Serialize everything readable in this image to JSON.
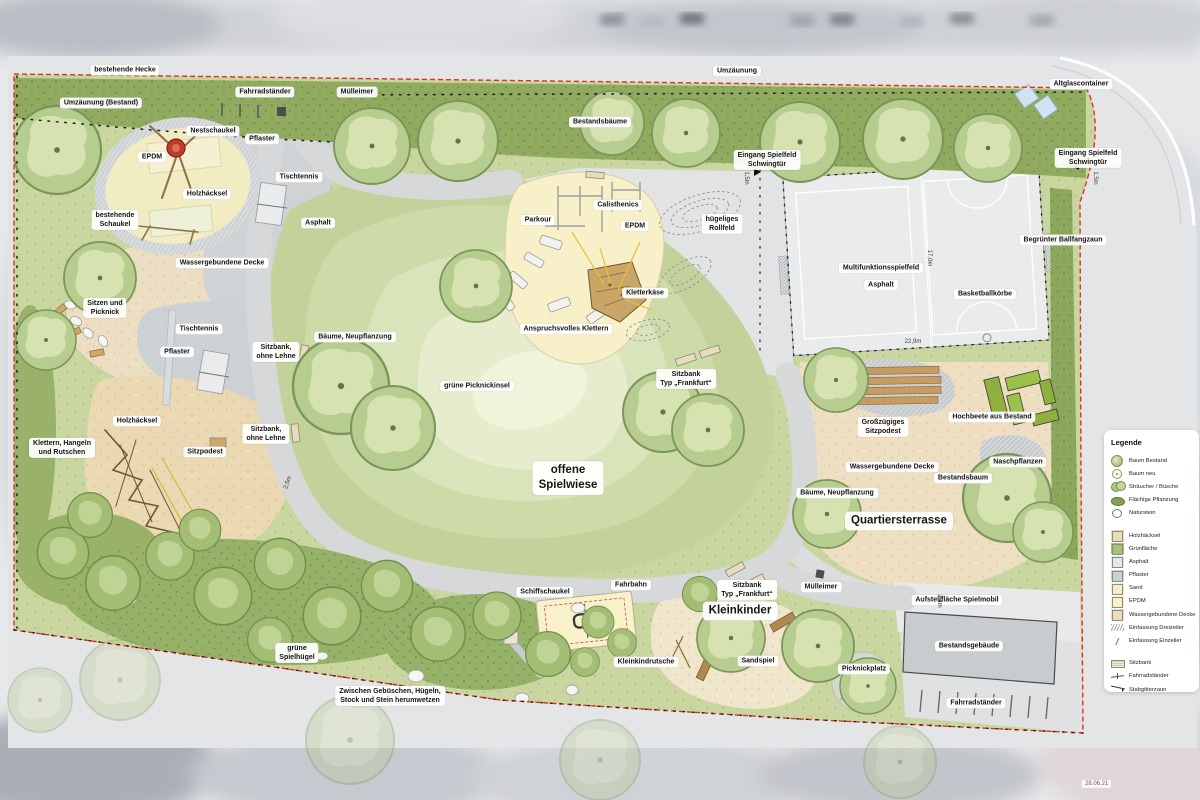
{
  "meta": {
    "date_stamp": "28.06.21"
  },
  "palette": {
    "boundary_red": "#e03024",
    "hedge_green": "#90aa60",
    "lawn_green": "#c9d6a0",
    "meadow_light": "#e7edcc",
    "path_gray": "#d7d8d9",
    "pflaster_gray": "#cfd3d6",
    "asphalt_gray": "#e6e7e9",
    "epdm_yellow": "#f7f0c8",
    "sand_beige": "#f0e6cb",
    "wgd_beige": "#ecdec2",
    "holzhaecksel_tan": "#ead9b2",
    "wood_brown": "#c79c63",
    "bed_green": "#9cc14a",
    "glass_blue": "#cfe3f0"
  },
  "plan_labels": [
    {
      "text": "bestehende Hecke",
      "x": 125,
      "y": 70
    },
    {
      "text": "Umzäunung (Bestand)",
      "x": 101,
      "y": 103
    },
    {
      "text": "Fahrradständer",
      "x": 265,
      "y": 92
    },
    {
      "text": "Mülleimer",
      "x": 357,
      "y": 92
    },
    {
      "text": "Umzäunung",
      "x": 737,
      "y": 71
    },
    {
      "text": "Bestandsbäume",
      "x": 600,
      "y": 122
    },
    {
      "text": "Altglascontainer",
      "x": 1081,
      "y": 84
    },
    {
      "text": "Eingang Spielfeld\nSchwingtür",
      "x": 767,
      "y": 160
    },
    {
      "text": "Eingang Spielfeld\nSchwingtür",
      "x": 1088,
      "y": 158
    },
    {
      "text": "Nestschaukel",
      "x": 213,
      "y": 131
    },
    {
      "text": "Pflaster",
      "x": 262,
      "y": 139
    },
    {
      "text": "EPDM",
      "x": 152,
      "y": 157
    },
    {
      "text": "Tischtennis",
      "x": 299,
      "y": 177
    },
    {
      "text": "Holzhäcksel",
      "x": 207,
      "y": 194
    },
    {
      "text": "bestehende\nSchaukel",
      "x": 115,
      "y": 220
    },
    {
      "text": "Asphalt",
      "x": 318,
      "y": 223
    },
    {
      "text": "Wassergebundene Decke",
      "x": 222,
      "y": 263
    },
    {
      "text": "Sitzen und\nPicknick",
      "x": 105,
      "y": 308
    },
    {
      "text": "Tischtennis",
      "x": 199,
      "y": 329
    },
    {
      "text": "Pflaster",
      "x": 177,
      "y": 352
    },
    {
      "text": "Sitzbank,\nohne Lehne",
      "x": 276,
      "y": 352
    },
    {
      "text": "Parkour",
      "x": 538,
      "y": 220
    },
    {
      "text": "Calisthenics",
      "x": 618,
      "y": 205
    },
    {
      "text": "EPDM",
      "x": 635,
      "y": 226
    },
    {
      "text": "hügeliges\nRollfeld",
      "x": 722,
      "y": 224
    },
    {
      "text": "Kletterkäse",
      "x": 645,
      "y": 293
    },
    {
      "text": "Anspruchsvolles Klettern",
      "x": 566,
      "y": 329
    },
    {
      "text": "Multifunktionsspielfeld",
      "x": 881,
      "y": 268
    },
    {
      "text": "Asphalt",
      "x": 881,
      "y": 285
    },
    {
      "text": "Basketballkörbe",
      "x": 985,
      "y": 294
    },
    {
      "text": "Begrünter Ballfangzaun",
      "x": 1063,
      "y": 240
    },
    {
      "text": "Bäume, Neupflanzung",
      "x": 355,
      "y": 337
    },
    {
      "text": "grüne Picknickinsel",
      "x": 477,
      "y": 386
    },
    {
      "text": "Sitzbank\nTyp „Frankfurt“",
      "x": 686,
      "y": 379
    },
    {
      "text": "Holzhäcksel",
      "x": 137,
      "y": 421
    },
    {
      "text": "Sitzbank,\nohne Lehne",
      "x": 266,
      "y": 434
    },
    {
      "text": "Klettern, Hangeln\nund Rutschen",
      "x": 62,
      "y": 448
    },
    {
      "text": "Sitzpodest",
      "x": 205,
      "y": 452
    },
    {
      "text": "Großzügiges\nSitzpodest",
      "x": 883,
      "y": 427
    },
    {
      "text": "Hochbeete aus Bestand",
      "x": 992,
      "y": 417
    },
    {
      "text": "Naschpflanzen",
      "x": 1018,
      "y": 462
    },
    {
      "text": "Wassergebundene Decke",
      "x": 892,
      "y": 467
    },
    {
      "text": "Bestandsbaum",
      "x": 963,
      "y": 478
    },
    {
      "text": "Bäume, Neupflanzung",
      "x": 837,
      "y": 493
    },
    {
      "text": "offene\nSpielwiese",
      "x": 568,
      "y": 478,
      "size": "lg"
    },
    {
      "text": "Quartiersterrasse",
      "x": 899,
      "y": 521,
      "size": "lg"
    },
    {
      "text": "Fahrbahn",
      "x": 631,
      "y": 585
    },
    {
      "text": "Schiffschaukel",
      "x": 545,
      "y": 592
    },
    {
      "text": "Sitzbank\nTyp „Frankfurt“",
      "x": 747,
      "y": 590
    },
    {
      "text": "Mülleimer",
      "x": 821,
      "y": 587
    },
    {
      "text": "Kleinkinder",
      "x": 740,
      "y": 611,
      "size": "lg"
    },
    {
      "text": "Aufstellfläche Spielmobil",
      "x": 957,
      "y": 600
    },
    {
      "text": "Kleinkindrutsche",
      "x": 646,
      "y": 662
    },
    {
      "text": "Sandspiel",
      "x": 758,
      "y": 661
    },
    {
      "text": "Picknickplatz",
      "x": 864,
      "y": 669
    },
    {
      "text": "grüne\nSpielhügel",
      "x": 297,
      "y": 653
    },
    {
      "text": "Bestandsgebäude",
      "x": 969,
      "y": 646
    },
    {
      "text": "Zwischen Gebüschen, Hügeln,\nStock und Stein herumwetzen",
      "x": 390,
      "y": 696
    },
    {
      "text": "Fahrradständer",
      "x": 976,
      "y": 703
    }
  ],
  "dimension_labels": [
    {
      "text": "17,0m",
      "x": 928,
      "y": 258,
      "rot": 90
    },
    {
      "text": "22,9m",
      "x": 913,
      "y": 343,
      "rot": 0
    },
    {
      "text": "1,5m",
      "x": 745,
      "y": 178,
      "rot": 90
    },
    {
      "text": "1,5m",
      "x": 1094,
      "y": 178,
      "rot": 90
    },
    {
      "text": "2,4m",
      "x": 938,
      "y": 601,
      "rot": 90
    },
    {
      "text": "2,5m",
      "x": 289,
      "y": 483,
      "rot": -70
    }
  ],
  "legend": {
    "title": "Legende",
    "groups": [
      {
        "items": [
          {
            "label": "Baum Bestand",
            "swatch": "tree-bestand"
          },
          {
            "label": "Baum neu",
            "swatch": "tree-neu"
          },
          {
            "label": "Sträucher / Büsche",
            "swatch": "shrub"
          },
          {
            "label": "Flächige Pflanzung",
            "swatch": "planting"
          },
          {
            "label": "Naturstein",
            "swatch": "naturstein"
          }
        ]
      },
      {
        "items": [
          {
            "label": "Holzhäcksel",
            "swatch": "square",
            "color": "#e9dbb8"
          },
          {
            "label": "Grünfläche",
            "swatch": "square",
            "color": "#a9c177"
          },
          {
            "label": "Asphalt",
            "swatch": "square",
            "color": "#e6e7e9"
          },
          {
            "label": "Pflaster",
            "swatch": "square",
            "color": "#ccd0d2"
          },
          {
            "label": "Sand",
            "swatch": "square",
            "color": "#f4ecca"
          },
          {
            "label": "EPDM",
            "swatch": "square",
            "color": "#f8f1c6"
          },
          {
            "label": "Wassergebundene Decke",
            "swatch": "square",
            "color": "#ecdcbc"
          },
          {
            "label": "Einfassung Dreizeiler",
            "swatch": "edge3"
          },
          {
            "label": "Einfassung Einzeiler",
            "swatch": "edge1"
          }
        ]
      },
      {
        "items": [
          {
            "label": "Sitzbank",
            "swatch": "bench"
          },
          {
            "label": "Fahrradständer",
            "swatch": "bikerack"
          },
          {
            "label": "Stabgitterzaun",
            "swatch": "fence"
          }
        ]
      }
    ]
  }
}
